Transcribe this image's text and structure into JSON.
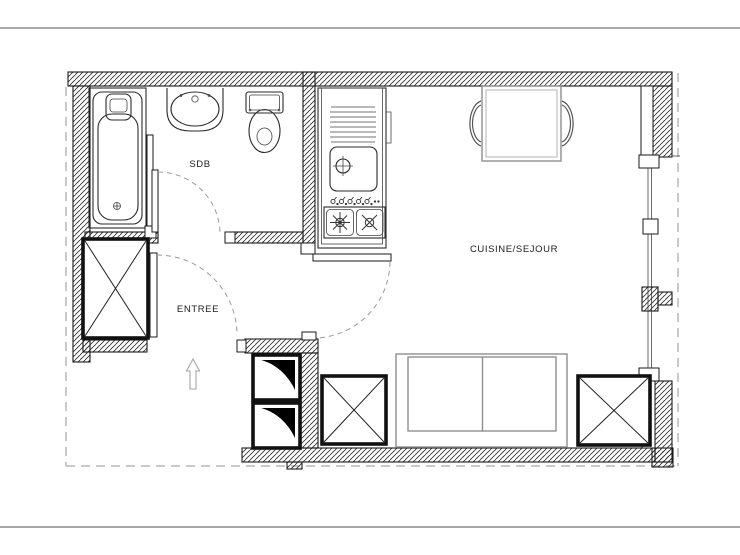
{
  "drawing": {
    "title": "Studio apartment floor plan",
    "rooms": [
      {
        "id": "sdb",
        "label": "SDB"
      },
      {
        "id": "entree",
        "label": "ENTREE"
      },
      {
        "id": "cuisine_sejour",
        "label": "CUISINE/SEJOUR"
      }
    ],
    "symbols": [
      "bathtub",
      "washbasin",
      "toilet",
      "kitchen-sink-stove-unit",
      "dining-table",
      "chairs",
      "wardrobe-crossed-boxes",
      "technical-shaft",
      "sofa",
      "entry-direction-arrow",
      "door-swing-arcs",
      "window-band"
    ]
  },
  "colors": {
    "line": "#1a1a1a",
    "furniture_gray": "#8f8f8f",
    "dashed_boundary": "#b7b7b7",
    "page_rule": "#8c8c8c",
    "background": "#ffffff"
  }
}
